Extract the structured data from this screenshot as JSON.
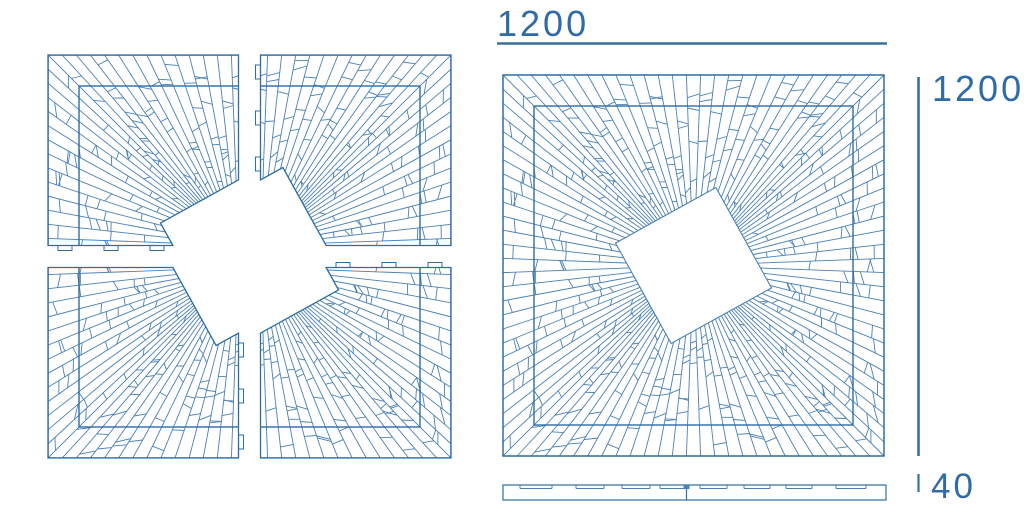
{
  "title": "Sunburst parquet panel technical drawing",
  "colors": {
    "background": "#ffffff",
    "pattern_line": "#4a80b5",
    "outline": "#2e6da4",
    "dimension_line": "#39709f",
    "label_text": "#2f6ba8"
  },
  "dimensions": {
    "top": {
      "label": "1200",
      "x1": 497,
      "x2": 887,
      "y": 43.5
    },
    "right": {
      "label": "1200",
      "x": 918.5,
      "y1": 77,
      "y2": 456
    },
    "thickness": {
      "label": "40",
      "x": 918.5,
      "y1": 474,
      "y2": 492
    }
  },
  "views": {
    "exploded": {
      "x": 59,
      "y": 66,
      "size": 381,
      "gap": 11
    },
    "assembled": {
      "x": 503,
      "y": 75,
      "size": 381
    },
    "profile": {
      "x": 503,
      "y": 485,
      "width": 383,
      "height": 15,
      "groove_depth": 3.5,
      "grooves": [
        [
          17,
          49
        ],
        [
          73,
          101
        ],
        [
          119,
          147
        ],
        [
          157,
          183
        ],
        [
          197,
          224
        ],
        [
          241,
          267
        ],
        [
          283,
          309
        ],
        [
          333,
          363
        ]
      ],
      "split_x": 183.5,
      "tongue": {
        "x": 180.5,
        "w": 6,
        "h": 4
      }
    }
  },
  "pattern": {
    "rays_per_side": 27,
    "inner_frame_inset": 31,
    "center_square_rotation_deg": 16,
    "center_square_radius_ratio": 0.213,
    "seed": 20240,
    "crosscut_min": 3,
    "crosscut_extra": 3,
    "tabs": {
      "length": 14,
      "depth": 5,
      "near_offsets": [
        10,
        56,
        102
      ],
      "far_offsets": [
        266,
        312,
        358
      ]
    }
  }
}
